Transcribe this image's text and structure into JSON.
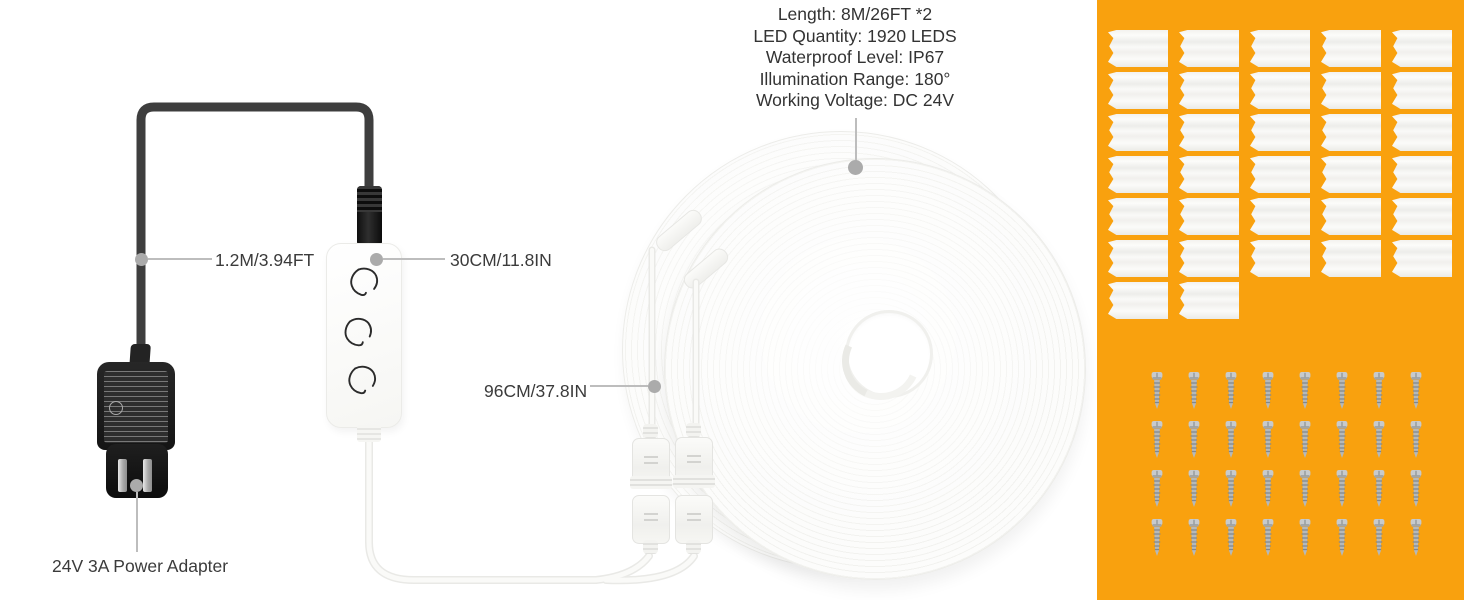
{
  "product": {
    "specs": [
      "Length: 8M/26FT *2",
      "LED Quantity: 1920 LEDS",
      "Waterproof Level: IP67",
      "Illumination Range: 180°",
      "Working Voltage: DC 24V"
    ],
    "callouts": {
      "adapter_cable": "1.2M/3.94FT",
      "controller_cable": "30CM/11.8IN",
      "splitter_cable": "96CM/37.8IN",
      "power_adapter": "24V 3A Power Adapter"
    },
    "accessories": {
      "clips_count": 32,
      "screws_count": 32
    },
    "items": {
      "led_coils": 2,
      "strip_connectors": 4,
      "controller_leaf_buttons": 3
    }
  },
  "colors": {
    "panel_orange": "#F9A10E",
    "text": "#3B3B3B",
    "leader_line": "#BDBDBD",
    "cable_black": "#3E3E3E",
    "coil_white": "#FCFCFB"
  }
}
